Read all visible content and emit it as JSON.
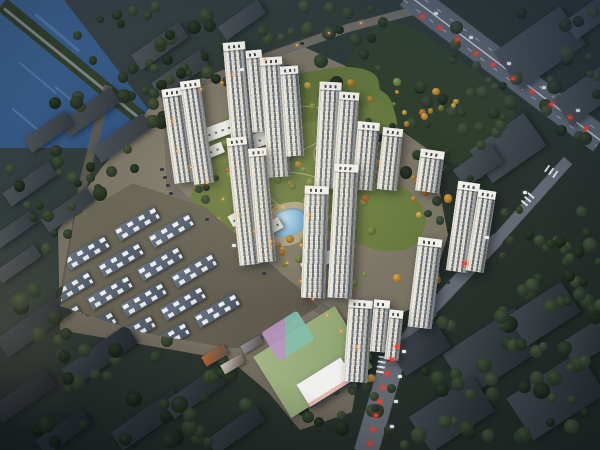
{
  "meta": {
    "description": "Aerial dusk rendering of a residential development: white high-rise towers around a central autumn park and pond, townhouse grid, school parcel, lake at top-left, highway with traffic at top-right, dark existing city blocks and forest surrounding."
  },
  "palette": {
    "water_light": "#3b5f8c",
    "water_dark": "#223f67",
    "water_streak": "#5d83ad",
    "causeway": "#2f3d2b",
    "causeway_road": "#8b9196",
    "site_ground": "#7a7465",
    "greenbelt": "#2f3e2a",
    "road": "#6e6a62",
    "road_dark": "#5a584f",
    "road_cool": "#646a74",
    "highway": "#5d6671",
    "park1": "#6f8040",
    "park2": "#66783c",
    "park3": "#6a7c3e",
    "park4": "#5f7038",
    "plaza": "#b5a98c",
    "pond_hi": "#bfe0ef",
    "pond_mid": "#7fb4d6",
    "pond_lo": "#5e97bf",
    "school_ground": "#93a877",
    "court_purple": "#b895c2",
    "court_teal": "#84bfae",
    "school_building": "#f0f0ee",
    "school_accent": "#c64a35",
    "car_red": "#e8452e",
    "car_white": "#e9edf2",
    "car_dark": "#2c3238",
    "car_orange": "#e8a050",
    "tree_dark": [
      [
        "#3e5036",
        "#242f21"
      ],
      [
        "#354630",
        "#1e281c"
      ],
      [
        "#2c3b29",
        "#172016"
      ],
      [
        "#46573c",
        "#2a3526"
      ]
    ],
    "tree_bright": [
      [
        "#d9bd58",
        "#97742a"
      ],
      [
        "#e2a94e",
        "#a06a20"
      ],
      [
        "#93a355",
        "#5a6a30"
      ],
      [
        "#c5973f",
        "#845f1e"
      ],
      [
        "#7f9048",
        "#4c5b2a"
      ],
      [
        "#d27e35",
        "#8f4f1a"
      ]
    ]
  },
  "water": {
    "poly": "0px 0px, 64px 0px, 178px 148px, 0px 148px",
    "streaks": [
      [
        28,
        32,
        58,
        3
      ],
      [
        14,
        78,
        48,
        2
      ],
      [
        50,
        100,
        42,
        2
      ],
      [
        8,
        120,
        36,
        2
      ]
    ]
  },
  "causeway": {
    "seg": [
      2,
      4,
      180,
      150
    ],
    "w": 15,
    "road_w": 3
  },
  "site_poly": "160px 95px, 300px 45px, 365px 75px, 432px 152px, 448px 235px, 428px 300px, 392px 318px, 362px 352px, 352px 412px, 300px 430px, 268px 392px, 230px 360px, 60px 330px, 58px 230px, 100px 170px",
  "greenbelt": [
    430,
    95,
    175,
    92,
    35
  ],
  "park_blobs": [
    [
      298,
      138,
      200,
      92,
      -16,
      "park1"
    ],
    [
      252,
      196,
      130,
      84,
      -26,
      "park2"
    ],
    [
      362,
      206,
      132,
      72,
      24,
      "park3"
    ],
    [
      320,
      95,
      120,
      50,
      -10,
      "park4"
    ]
  ],
  "park_paths": [
    [
      285,
      130,
      95,
      44,
      -14
    ],
    [
      305,
      195,
      85,
      40,
      18
    ],
    [
      262,
      225,
      64,
      32,
      -28
    ],
    [
      345,
      165,
      70,
      36,
      30
    ]
  ],
  "plaza": [
    288,
    224,
    60,
    42,
    -20
  ],
  "pond": [
    288,
    222,
    40,
    27,
    -20
  ],
  "roads": [
    {
      "seg": [
        165,
        98,
        258,
        60
      ],
      "w": 8,
      "c": "road"
    },
    {
      "seg": [
        258,
        60,
        348,
        28
      ],
      "w": 8,
      "c": "road"
    },
    {
      "seg": [
        348,
        28,
        416,
        10
      ],
      "w": 8,
      "c": "road"
    },
    {
      "seg": [
        167,
        92,
        172,
        190
      ],
      "w": 11,
      "c": "road"
    },
    {
      "seg": [
        172,
        190,
        242,
        252
      ],
      "w": 12,
      "c": "road"
    },
    {
      "seg": [
        242,
        252,
        302,
        296
      ],
      "w": 12,
      "c": "road"
    },
    {
      "seg": [
        302,
        296,
        352,
        330
      ],
      "w": 12,
      "c": "road"
    },
    {
      "seg": [
        108,
        86,
        84,
        180
      ],
      "w": 8,
      "c": "road_dark"
    },
    {
      "seg": [
        84,
        180,
        62,
        302
      ],
      "w": 8,
      "c": "road_dark"
    },
    {
      "seg": [
        568,
        160,
        498,
        238
      ],
      "w": 11,
      "c": "road_cool"
    },
    {
      "seg": [
        498,
        238,
        430,
        310
      ],
      "w": 13,
      "c": "road_cool"
    },
    {
      "seg": [
        430,
        310,
        392,
        362
      ],
      "w": 16,
      "c": "road_cool"
    },
    {
      "seg": [
        392,
        362,
        366,
        452
      ],
      "w": 24,
      "c": "road_cool"
    }
  ],
  "highway": {
    "seg": [
      408,
      -6,
      601,
      140
    ],
    "w": 27
  },
  "crosswalks": [
    [
      552,
      172,
      35,
      14,
      8
    ],
    [
      527,
      200,
      131,
      14,
      8
    ],
    [
      381,
      366,
      100,
      20,
      8
    ],
    [
      306,
      300,
      41,
      12,
      7
    ]
  ],
  "city_buildings": [
    [
      160,
      46,
      58,
      18,
      -35,
      0
    ],
    [
      180,
      74,
      58,
      18,
      -35,
      0
    ],
    [
      242,
      20,
      48,
      16,
      -35,
      0
    ],
    [
      90,
      112,
      62,
      18,
      -35,
      0
    ],
    [
      122,
      138,
      62,
      18,
      -35,
      0
    ],
    [
      48,
      132,
      50,
      16,
      -35,
      0
    ],
    [
      30,
      184,
      56,
      16,
      -35,
      0
    ],
    [
      68,
      210,
      56,
      16,
      -35,
      0
    ],
    [
      14,
      230,
      46,
      14,
      -35,
      0
    ],
    [
      18,
      264,
      48,
      14,
      -35,
      0
    ],
    [
      34,
      326,
      78,
      22,
      -35,
      1
    ],
    [
      100,
      356,
      78,
      22,
      -35,
      1
    ],
    [
      24,
      396,
      66,
      20,
      -35,
      1
    ],
    [
      148,
      420,
      76,
      22,
      -35,
      1
    ],
    [
      64,
      432,
      56,
      18,
      -35,
      1
    ],
    [
      196,
      392,
      66,
      20,
      -35,
      1
    ],
    [
      236,
      430,
      60,
      18,
      -35,
      1
    ],
    [
      492,
      352,
      86,
      50,
      -33,
      1
    ],
    [
      556,
      396,
      86,
      50,
      -33,
      1
    ],
    [
      452,
      414,
      76,
      42,
      -33,
      1
    ],
    [
      544,
      314,
      64,
      36,
      -33,
      1
    ],
    [
      420,
      348,
      54,
      32,
      -33,
      1
    ],
    [
      588,
      342,
      48,
      28,
      -33,
      1
    ],
    [
      508,
      148,
      66,
      40,
      -35,
      0
    ],
    [
      540,
      48,
      80,
      46,
      -35,
      0
    ],
    [
      586,
      96,
      58,
      32,
      -35,
      0
    ],
    [
      478,
      166,
      46,
      22,
      -35,
      0
    ],
    [
      588,
      18,
      44,
      22,
      -35,
      0
    ]
  ],
  "midrise": [
    [
      226,
      128,
      44,
      14,
      -20
    ],
    [
      250,
      143,
      44,
      14,
      -20
    ],
    [
      270,
      157,
      40,
      13,
      -20
    ],
    [
      209,
      152,
      30,
      11,
      -22
    ],
    [
      246,
      213,
      36,
      12,
      -30
    ],
    [
      265,
      231,
      36,
      12,
      -30
    ],
    [
      350,
      172,
      34,
      12,
      20
    ],
    [
      318,
      262,
      34,
      12,
      -25
    ]
  ],
  "towers": [
    [
      178,
      88,
      20,
      95,
      -8
    ],
    [
      197,
      80,
      20,
      104,
      -8
    ],
    [
      239,
      42,
      22,
      120,
      -5
    ],
    [
      257,
      50,
      16,
      82,
      -5
    ],
    [
      275,
      57,
      22,
      120,
      -4
    ],
    [
      292,
      66,
      18,
      90,
      -4
    ],
    [
      328,
      82,
      22,
      106,
      3
    ],
    [
      346,
      92,
      20,
      98,
      4
    ],
    [
      366,
      122,
      22,
      68,
      5
    ],
    [
      390,
      128,
      20,
      62,
      6
    ],
    [
      430,
      150,
      24,
      42,
      8
    ],
    [
      463,
      182,
      22,
      90,
      8
    ],
    [
      481,
      190,
      18,
      82,
      9
    ],
    [
      425,
      238,
      24,
      90,
      7
    ],
    [
      358,
      300,
      24,
      82,
      4
    ],
    [
      380,
      300,
      16,
      52,
      5
    ],
    [
      394,
      310,
      14,
      50,
      6
    ],
    [
      315,
      186,
      24,
      112,
      2
    ],
    [
      343,
      164,
      24,
      134,
      3
    ],
    [
      243,
      137,
      20,
      128,
      -6
    ],
    [
      262,
      148,
      18,
      114,
      -5
    ]
  ],
  "townhouses": {
    "cx": 193,
    "cy": 263,
    "rot": -30,
    "rows": 6,
    "cols": 4,
    "pw": 58,
    "ph": 23,
    "bw": 46,
    "bh": 14,
    "stagger": 26,
    "clip": "92px 170px, 205px 207px, 312px 300px, 345px 336px, 298px 348px, 228px 348px, 140px 332px, 60px 306px, 78px 198px"
  },
  "amenity_blocks": [
    [
      215,
      355,
      26,
      11,
      -30,
      "#b86a32"
    ],
    [
      233,
      364,
      24,
      10,
      -30,
      "#d8d4c8"
    ],
    [
      252,
      344,
      22,
      9,
      -30,
      "#8f9398"
    ]
  ],
  "school": {
    "parcel": [
      313,
      362,
      96,
      72,
      -32
    ],
    "playground": [
      288,
      336,
      42,
      34,
      -32
    ],
    "building": [
      326,
      382,
      52,
      26,
      -32
    ]
  },
  "trees_dark": [
    [
      55,
      6,
      160,
      72,
      22,
      1,
      7,
      15
    ],
    [
      215,
      4,
      170,
      80,
      24,
      2,
      7,
      14
    ],
    [
      320,
      55,
      185,
      120,
      32,
      3,
      6,
      13
    ],
    [
      455,
      12,
      145,
      135,
      26,
      4,
      7,
      15
    ],
    [
      45,
      95,
      130,
      95,
      18,
      5,
      7,
      14
    ],
    [
      8,
      162,
      95,
      150,
      20,
      6,
      7,
      15
    ],
    [
      18,
      298,
      265,
      145,
      48,
      7,
      8,
      17
    ],
    [
      298,
      383,
      135,
      62,
      15,
      8,
      8,
      15
    ],
    [
      418,
      298,
      185,
      145,
      44,
      9,
      8,
      17
    ],
    [
      498,
      192,
      105,
      125,
      24,
      10,
      7,
      15
    ],
    [
      118,
      52,
      85,
      62,
      10,
      11,
      7,
      13
    ],
    [
      552,
      242,
      52,
      66,
      10,
      12,
      7,
      13
    ],
    [
      175,
      160,
      55,
      45,
      8,
      13,
      6,
      11
    ],
    [
      425,
      178,
      60,
      55,
      9,
      14,
      6,
      12
    ]
  ],
  "trees_bright": [
    [
      215,
      80,
      200,
      115,
      30,
      21,
      4,
      9
    ],
    [
      230,
      170,
      150,
      105,
      24,
      22,
      4,
      9
    ],
    [
      325,
      175,
      125,
      110,
      20,
      23,
      4,
      9
    ],
    [
      245,
      232,
      110,
      72,
      16,
      24,
      4,
      8
    ],
    [
      95,
      195,
      235,
      145,
      40,
      25,
      3,
      7
    ],
    [
      290,
      318,
      95,
      72,
      12,
      26,
      4,
      8
    ],
    [
      345,
      90,
      130,
      65,
      14,
      27,
      4,
      8
    ],
    [
      180,
      128,
      70,
      60,
      10,
      28,
      4,
      8
    ]
  ],
  "cars": [
    [
      420,
      15,
      "r"
    ],
    [
      438,
      26,
      "r"
    ],
    [
      455,
      38,
      "r"
    ],
    [
      474,
      52,
      "r"
    ],
    [
      491,
      63,
      "r"
    ],
    [
      511,
      77,
      "r"
    ],
    [
      530,
      90,
      "r"
    ],
    [
      549,
      103,
      "r"
    ],
    [
      568,
      116,
      "r"
    ],
    [
      584,
      127,
      "r"
    ],
    [
      434,
      12,
      "w"
    ],
    [
      469,
      36,
      "w"
    ],
    [
      507,
      62,
      "w"
    ],
    [
      542,
      86,
      "w"
    ],
    [
      576,
      109,
      "w"
    ],
    [
      523,
      191,
      "w"
    ],
    [
      507,
      210,
      "d"
    ],
    [
      485,
      236,
      "w"
    ],
    [
      463,
      262,
      "r"
    ],
    [
      446,
      281,
      "d"
    ],
    [
      395,
      345,
      "r"
    ],
    [
      390,
      358,
      "r"
    ],
    [
      385,
      372,
      "r"
    ],
    [
      381,
      386,
      "r"
    ],
    [
      378,
      400,
      "r"
    ],
    [
      374,
      414,
      "r"
    ],
    [
      371,
      428,
      "r"
    ],
    [
      368,
      442,
      "r"
    ],
    [
      402,
      350,
      "w"
    ],
    [
      398,
      375,
      "w"
    ],
    [
      394,
      400,
      "w"
    ],
    [
      390,
      425,
      "w"
    ],
    [
      205,
      218,
      "d"
    ],
    [
      232,
      244,
      "w"
    ],
    [
      262,
      272,
      "d"
    ],
    [
      160,
      168,
      "d"
    ],
    [
      163,
      176,
      "d"
    ],
    [
      166,
      184,
      "d"
    ],
    [
      169,
      192,
      "d"
    ],
    [
      240,
      68,
      "w"
    ],
    [
      300,
      42,
      "d"
    ]
  ],
  "lights": [
    [
      176,
      150
    ],
    [
      190,
      166
    ],
    [
      206,
      182
    ],
    [
      222,
      198
    ],
    [
      238,
      214
    ],
    [
      254,
      230
    ],
    [
      270,
      246
    ],
    [
      286,
      262
    ],
    [
      300,
      280
    ],
    [
      312,
      298
    ],
    [
      326,
      314
    ],
    [
      340,
      330
    ],
    [
      356,
      346
    ],
    [
      172,
      120
    ],
    [
      200,
      88
    ],
    [
      232,
      74
    ],
    [
      264,
      58
    ],
    [
      296,
      44
    ],
    [
      328,
      32
    ],
    [
      360,
      22
    ],
    [
      270,
      240
    ],
    [
      300,
      244
    ],
    [
      282,
      206
    ],
    [
      308,
      214
    ]
  ]
}
